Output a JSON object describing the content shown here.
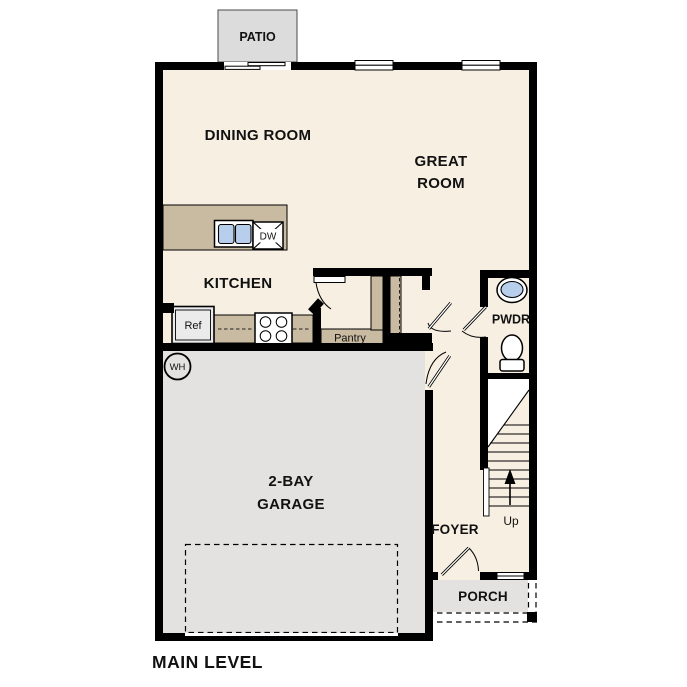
{
  "plan_title": "MAIN LEVEL",
  "rooms": {
    "patio": "PATIO",
    "dining": "DINING ROOM",
    "great_line1": "GREAT",
    "great_line2": "ROOM",
    "kitchen": "KITCHEN",
    "pantry": "Pantry",
    "powder": "PWDR",
    "garage_line1": "2-BAY",
    "garage_line2": "GARAGE",
    "foyer": "FOYER",
    "porch": "PORCH"
  },
  "fixtures": {
    "dishwasher": "DW",
    "refrigerator": "Ref",
    "water_heater": "WH",
    "stairs_direction": "Up"
  },
  "colors": {
    "floor": "#f7f0e2",
    "concrete": "#e3e2e0",
    "patio": "#dcdcdc",
    "cabinet": "#c9bba1",
    "appliance": "#ebebeb",
    "water": "#b7cfec",
    "wall": "#000000"
  }
}
